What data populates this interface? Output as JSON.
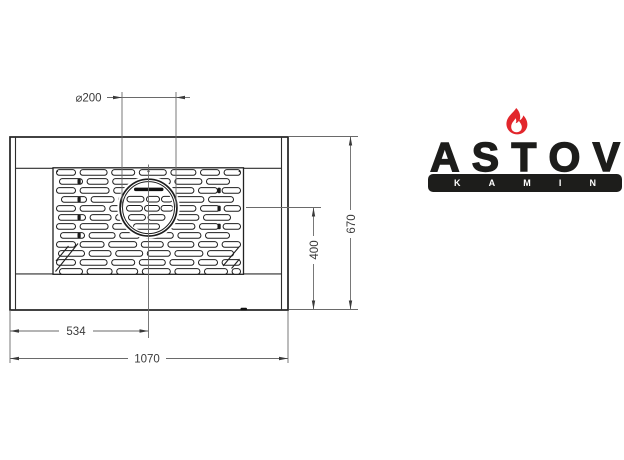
{
  "drawing": {
    "dim_diameter": "⌀200",
    "dim_width_center": "534",
    "dim_width_total": "1070",
    "dim_depth_partial": "400",
    "dim_depth_total": "670"
  },
  "logo": {
    "brand": "ASTOV",
    "sub": "KAMIN"
  },
  "colors": {
    "line": "#222222",
    "dimension": "#6a6a6a",
    "dimension_text": "#3a3a3a",
    "logo_black": "#1d1d1b",
    "flame_red": "#e2262c",
    "background": "#ffffff"
  }
}
